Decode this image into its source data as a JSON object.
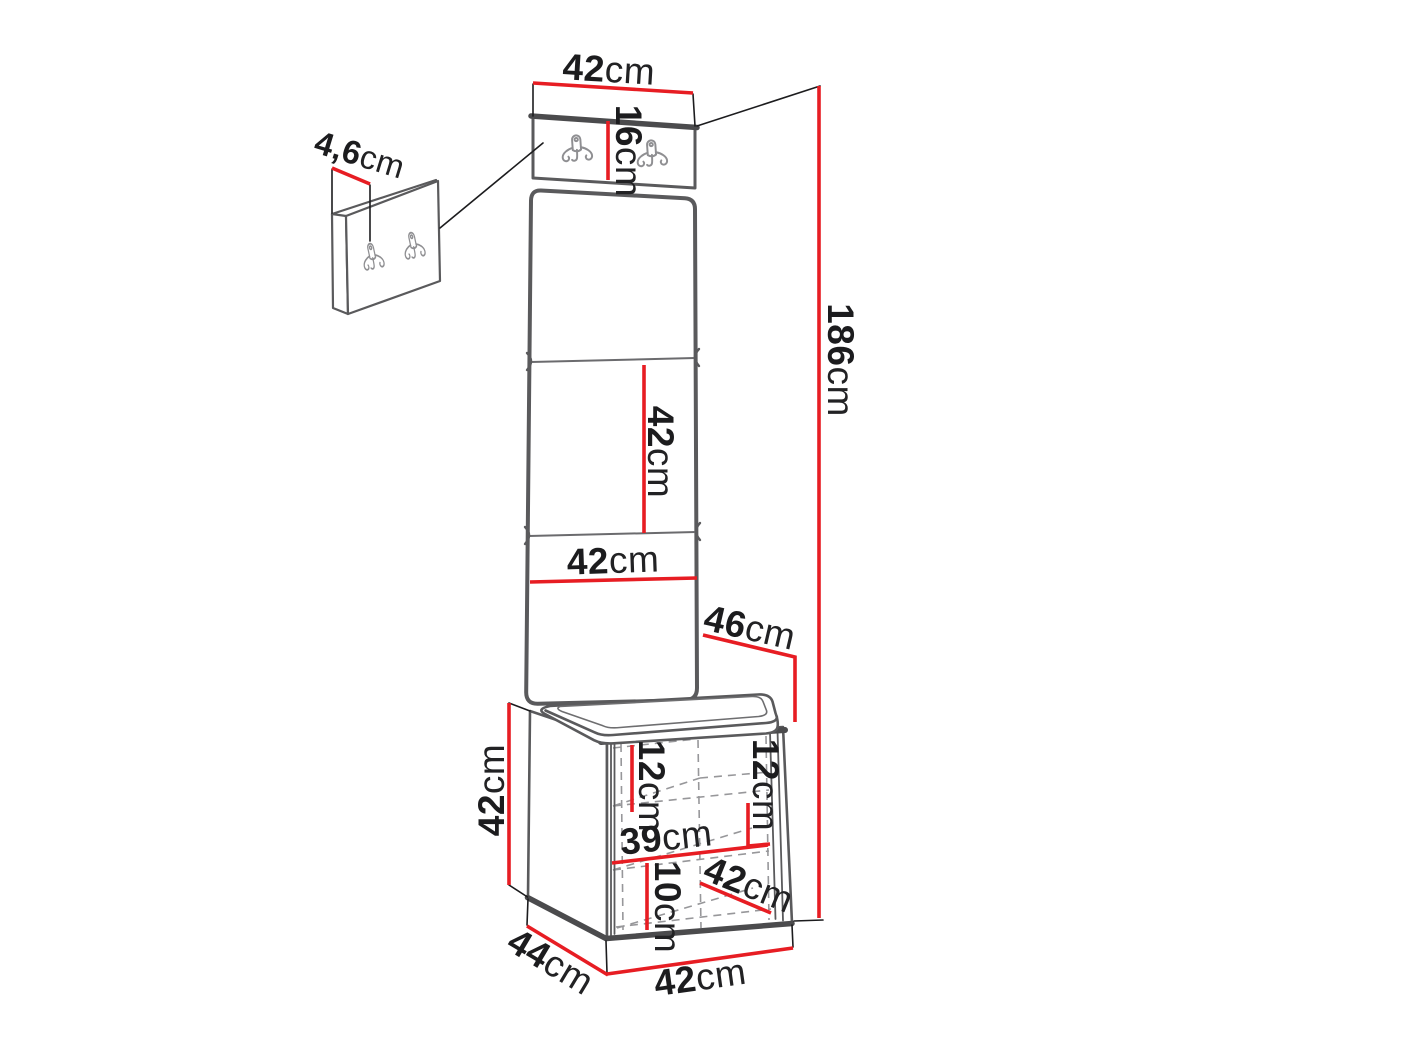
{
  "diagram": {
    "dimensions": {
      "width_top": {
        "value": "42",
        "unit": "cm"
      },
      "hook_panel_height": {
        "value": "16",
        "unit": "cm"
      },
      "wall_panel_thickness": {
        "value": "4,6",
        "unit": "cm"
      },
      "total_height": {
        "value": "186",
        "unit": "cm"
      },
      "panel_section_height": {
        "value": "42",
        "unit": "cm"
      },
      "panel_width": {
        "value": "42",
        "unit": "cm"
      },
      "seat_depth": {
        "value": "46",
        "unit": "cm"
      },
      "bench_height": {
        "value": "42",
        "unit": "cm"
      },
      "top_shelf_spacing": {
        "value": "12",
        "unit": "cm"
      },
      "right_shelf_spacing": {
        "value": "12",
        "unit": "cm"
      },
      "inner_width": {
        "value": "39",
        "unit": "cm"
      },
      "bottom_shelf_spacing": {
        "value": "10",
        "unit": "cm"
      },
      "inner_depth": {
        "value": "42",
        "unit": "cm"
      },
      "bench_depth": {
        "value": "44",
        "unit": "cm"
      },
      "bench_width": {
        "value": "42",
        "unit": "cm"
      }
    },
    "colors": {
      "dimension_red": "#e71d23",
      "outline_gray": "#5a5a5c",
      "edge_dark": "#4b4b4d",
      "hidden_line_gray": "#97979a",
      "text_black": "#1c1c1e"
    },
    "icons": {
      "hook": "double-coat-hook-icon"
    }
  }
}
